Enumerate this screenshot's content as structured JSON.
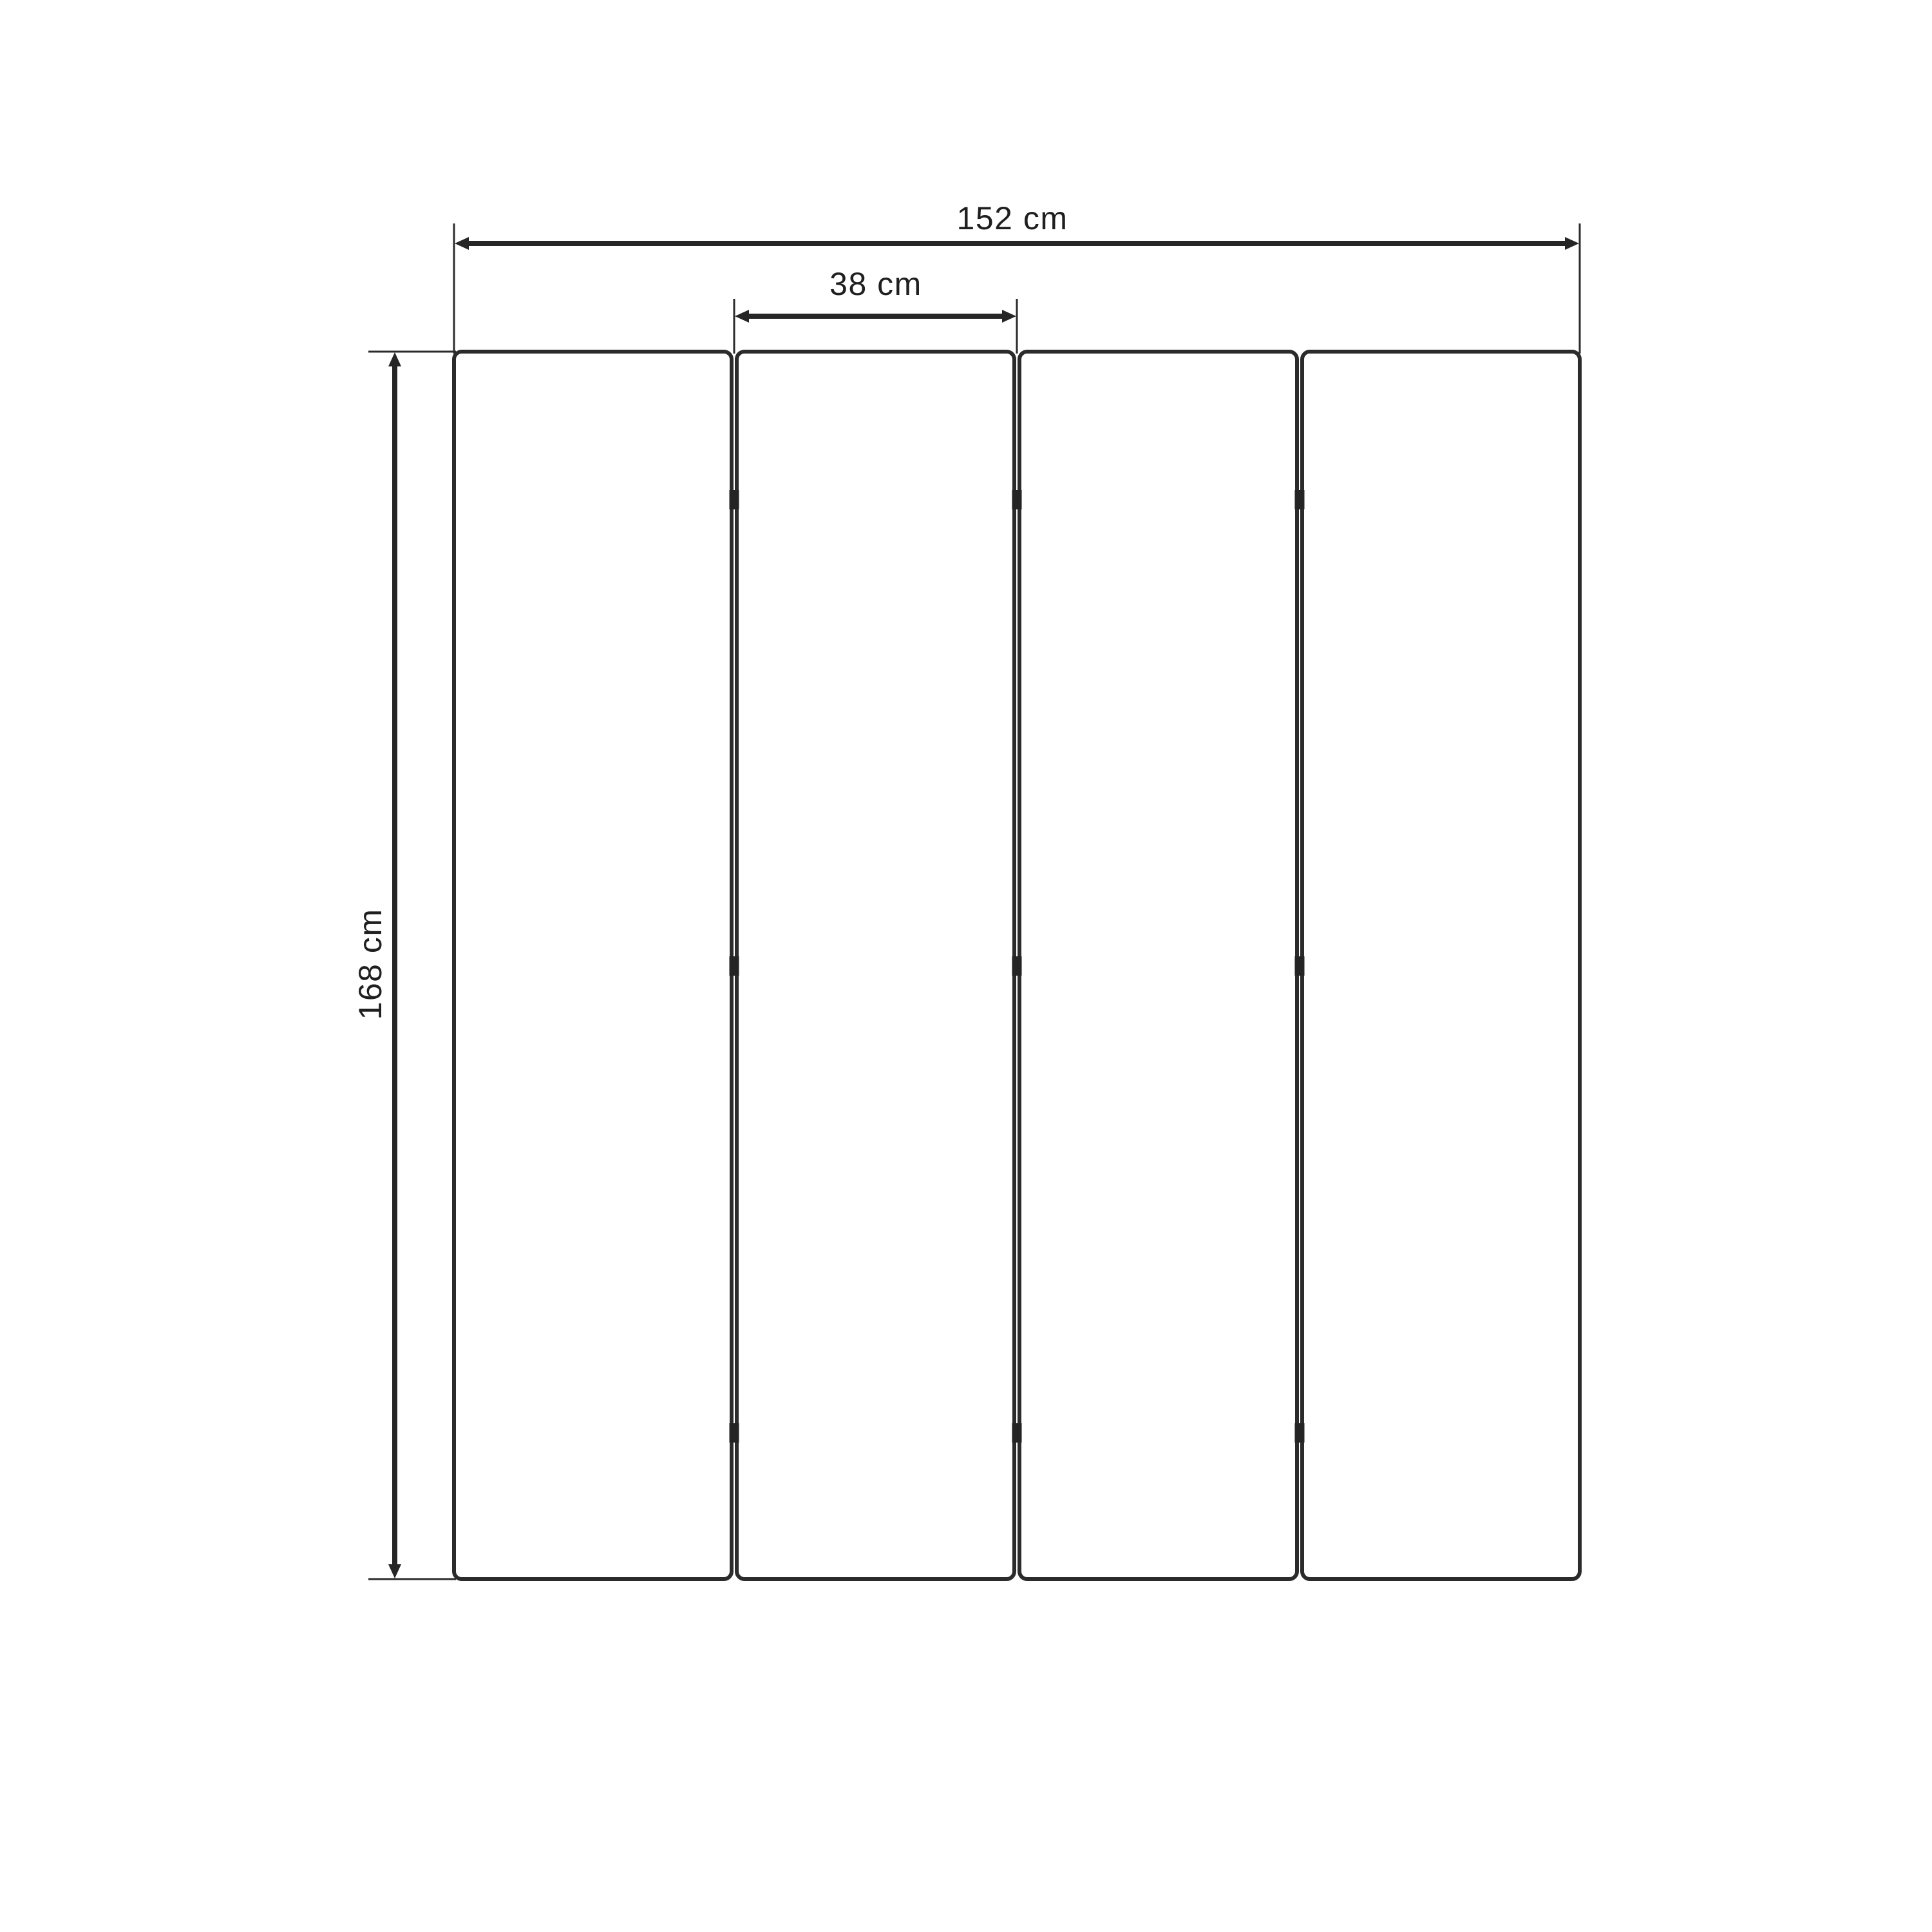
{
  "diagram": {
    "type": "furniture-dimension-drawing",
    "subject": "four-panel folding screen (room divider), front view",
    "structure": {
      "panel_count": 4,
      "hinge_rows_per_gap": 3
    },
    "dimensions": {
      "total_width": "152 cm",
      "single_panel_width": "38 cm",
      "height": "168 cm"
    },
    "colors": {
      "background": "#ffffff",
      "line": "#2b2b2b",
      "hinge": "#242424",
      "text": "#1f1f1f"
    }
  }
}
